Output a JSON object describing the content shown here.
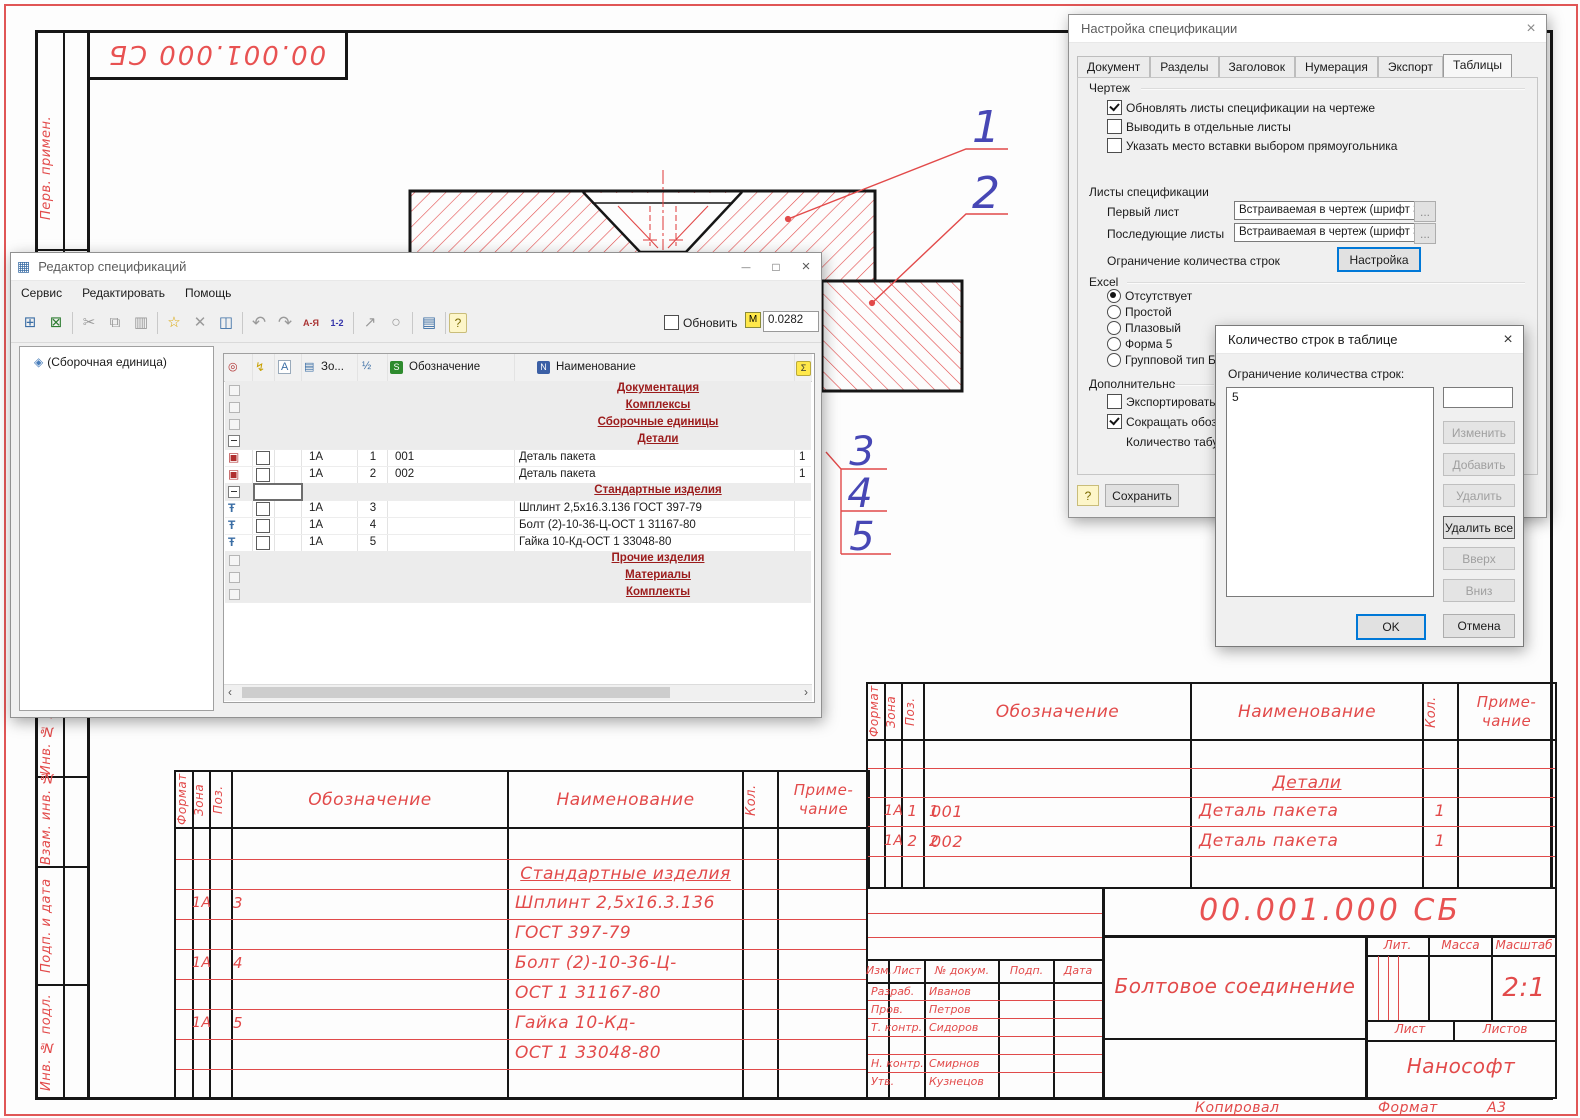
{
  "colors": {
    "cad_red": "#e24a4a",
    "callout_blue": "#4747b5",
    "line_black": "#161616",
    "accent": "#0078d7",
    "section_text": "#9b1b1b"
  },
  "sheet": {
    "doc_number": "00.001.000 СБ",
    "margin_labels": [
      "Перв. примен.",
      "Инв. № дубл.",
      "Взам. инв. №",
      "Подп. и дата",
      "Инв. № подл."
    ],
    "callouts": [
      "1",
      "2",
      "3",
      "4",
      "5"
    ],
    "footer": {
      "kopiroval": "Копировал",
      "format_label": "Формат",
      "format_value": "А3"
    },
    "spec_header": {
      "format": "Формат",
      "zona": "Зона",
      "poz": "Поз.",
      "oboz": "Обозначение",
      "naim": "Наименование",
      "kol": "Кол.",
      "prim1": "Приме-",
      "prim2": "чание"
    },
    "left_table": {
      "section": "Стандартные изделия",
      "rows": [
        {
          "zona": "1А",
          "poz": "3",
          "naim": "Шплинт 2,5х16.3.136"
        },
        {
          "zona": "",
          "poz": "",
          "naim": "ГОСТ 397-79"
        },
        {
          "zona": "1А",
          "poz": "4",
          "naim": "Болт (2)-10-36-Ц-"
        },
        {
          "zona": "",
          "poz": "",
          "naim": "ОСТ 1 31167-80"
        },
        {
          "zona": "1А",
          "poz": "5",
          "naim": "Гайка 10-Кд-"
        },
        {
          "zona": "",
          "poz": "",
          "naim": "ОСТ 1 33048-80"
        }
      ]
    },
    "right_table": {
      "section": "Детали",
      "rows": [
        {
          "zona": "1А",
          "poz": "1",
          "oboz": "001",
          "naim": "Деталь пакета",
          "kol": "1"
        },
        {
          "zona": "1А",
          "poz": "2",
          "oboz": "002",
          "naim": "Деталь пакета",
          "kol": "1"
        }
      ]
    },
    "title_block": {
      "doc_number": "00.001.000 СБ",
      "title": "Болтовое соединение",
      "company": "Нанософт",
      "scale_value": "2:1",
      "labels": {
        "izm": "Изм.",
        "list": "Лист",
        "n_dokum": "№ докум.",
        "podp": "Подп.",
        "data": "Дата",
        "lit": "Лит.",
        "massa": "Масса",
        "masshtab": "Масштаб",
        "list2": "Лист",
        "listov": "Листов"
      },
      "rows": [
        {
          "label": "Разраб.",
          "name": "Иванов"
        },
        {
          "label": "Пров.",
          "name": "Петров"
        },
        {
          "label": "Т. контр.",
          "name": "Сидоров"
        },
        {
          "label": "",
          "name": ""
        },
        {
          "label": "Н. контр.",
          "name": "Смирнов"
        },
        {
          "label": "Утв.",
          "name": "Кузнецов"
        }
      ]
    }
  },
  "editor": {
    "title": "Редактор спецификаций",
    "menu": [
      "Сервис",
      "Редактировать",
      "Помощь"
    ],
    "win": {
      "min": "—",
      "max": "□",
      "close": "×"
    },
    "toolbar": [
      {
        "n": "add-to-drawing-icon",
        "g": "⊞"
      },
      {
        "n": "export-excel-icon",
        "g": "⊠"
      },
      {
        "n": "cut-icon",
        "g": "✂"
      },
      {
        "n": "copy-icon",
        "g": "⧉"
      },
      {
        "n": "paste-icon",
        "g": "▥"
      },
      {
        "n": "new-item-icon",
        "g": "☆"
      },
      {
        "n": "delete-icon",
        "g": "✕"
      },
      {
        "n": "position-icon",
        "g": "◫"
      },
      {
        "n": "undo-icon",
        "g": "↶"
      },
      {
        "n": "redo-icon",
        "g": "↷"
      },
      {
        "n": "sort-alpha-icon",
        "g": "А-Я"
      },
      {
        "n": "sort-num-icon",
        "g": "1-2"
      },
      {
        "n": "leader-icon",
        "g": "↗"
      },
      {
        "n": "search-icon",
        "g": "○"
      },
      {
        "n": "properties-icon",
        "g": "▤"
      },
      {
        "n": "help-icon",
        "g": "?"
      }
    ],
    "update_label": "Обновить",
    "mass_badge": "М",
    "mass_value": "0.0282",
    "tree": {
      "root": "(Сборочная единица)"
    },
    "icons": {
      "app": "▦",
      "assembly": "◈",
      "detail": "▣",
      "std": "Ŧ"
    },
    "hicons": {
      "pin": "◎",
      "power": "↯",
      "a": "A",
      "zona": "▤",
      "half": "½",
      "s": "S",
      "n": "N",
      "sum": "Σ"
    },
    "header": {
      "zona": "Зо...",
      "oboz": "Обозначение",
      "naim": "Наименование"
    },
    "rows": [
      {
        "label": "Документация"
      },
      {
        "label": "Комплексы"
      },
      {
        "label": "Сборочные единицы"
      },
      {
        "label": "Детали"
      },
      {
        "zona": "1A",
        "poz": "1",
        "oboz": "001",
        "naim": "Деталь пакета",
        "kol": "1"
      },
      {
        "zona": "1A",
        "poz": "2",
        "oboz": "002",
        "naim": "Деталь пакета",
        "kol": "1"
      },
      {
        "label": "Стандартные изделия"
      },
      {
        "zona": "1A",
        "poz": "3",
        "naim": "Шплинт 2,5х16.3.136 ГОСТ 397-79"
      },
      {
        "zona": "1A",
        "poz": "4",
        "naim": "Болт (2)-10-36-Ц-ОСТ 1 31167-80"
      },
      {
        "zona": "1A",
        "poz": "5",
        "naim": "Гайка 10-Кд-ОСТ 1 33048-80"
      },
      {
        "label": "Прочие изделия"
      },
      {
        "label": "Материалы"
      },
      {
        "label": "Комплекты"
      }
    ],
    "scroll": {
      "left": "‹",
      "right": "›"
    }
  },
  "settings": {
    "title": "Настройка спецификации",
    "close": "×",
    "tabs": [
      "Документ",
      "Разделы",
      "Заголовок",
      "Нумерация",
      "Экспорт",
      "Таблицы"
    ],
    "group_drawing": "Чертеж",
    "cb1": "Обновлять листы спецификации на чертеже",
    "cb2": "Выводить в отдельные листы",
    "cb3": "Указать место вставки выбором прямоугольника",
    "sheets_label": "Листы спецификации",
    "first_sheet": "Первый лист",
    "next_sheets": "Последующие листы",
    "sheet_value": "Встраиваемая в чертеж (шрифт 3,5",
    "ellipsis": "...",
    "limit_label": "Ограничение количества строк",
    "setup_btn": "Настройка",
    "group_excel": "Excel",
    "radios": [
      "Отсутствует",
      "Простой",
      "Плазовый",
      "Форма 5",
      "Групповой тип Б"
    ],
    "group_additional": "Дополнительно",
    "cb4": "Экспортировать \"Ма",
    "cb5": "Сокращать обозначе",
    "tab_count_label": "Количество табуляц",
    "help_btn": "?",
    "save_btn": "Сохранить"
  },
  "rows_dialog": {
    "title": "Количество строк в таблице",
    "close": "×",
    "label": "Ограничение количества строк:",
    "list_items": [
      "5"
    ],
    "buttons": {
      "change": "Изменить",
      "add": "Добавить",
      "del": "Удалить",
      "del_all": "Удалить все",
      "up": "Вверх",
      "down": "Вниз",
      "ok": "OK",
      "cancel": "Отмена"
    }
  }
}
